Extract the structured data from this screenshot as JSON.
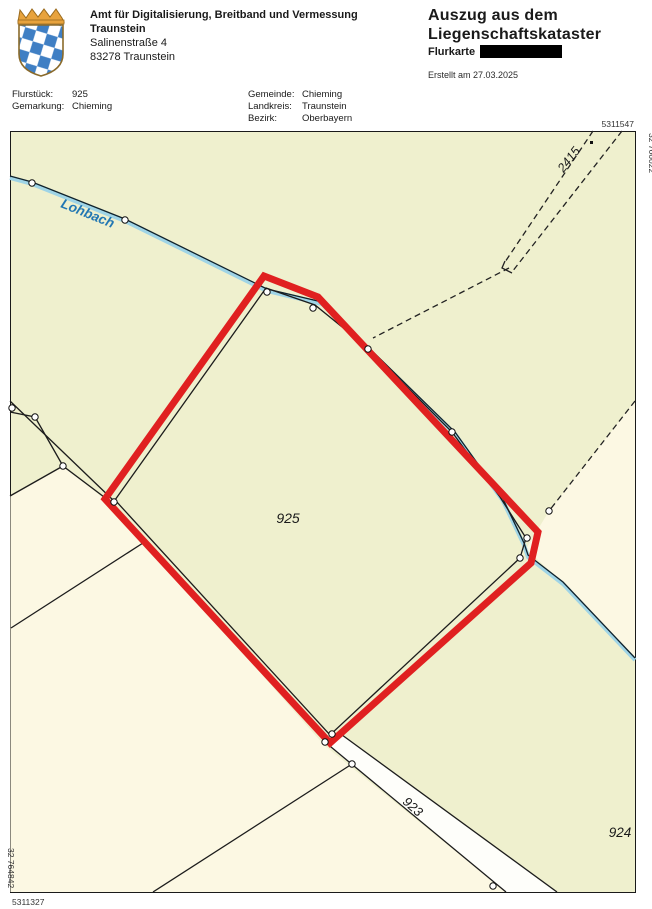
{
  "header": {
    "office_line1": "Amt für Digitalisierung, Breitband und Vermessung",
    "office_line2": "Traunstein",
    "address_street": "Salinenstraße 4",
    "address_city": "83278 Traunstein",
    "title_line1": "Auszug aus dem",
    "title_line2": "Liegenschaftskataster",
    "subtitle_label": "Flurkarte",
    "created_text": "Erstellt am 27.03.2025"
  },
  "info": {
    "left": [
      {
        "label": "Flurstück:",
        "value": "925"
      },
      {
        "label": "Gemarkung:",
        "value": "Chieming"
      }
    ],
    "right": [
      {
        "label": "Gemeinde:",
        "value": "Chieming"
      },
      {
        "label": "Landkreis:",
        "value": "Traunstein"
      },
      {
        "label": "Bezirk:",
        "value": "Oberbayern"
      }
    ]
  },
  "map": {
    "labels": {
      "stream": "Lohbach",
      "parcel_main": "925",
      "parcel_road": "923",
      "parcel_east": "924",
      "parcel_track": "2415"
    },
    "coords": {
      "top_right_northing": "5311547",
      "right_easting": "32 766022",
      "bottom_left_northing": "5311327",
      "left_easting": "32 764842"
    },
    "colors": {
      "highlight_red": "#e02020",
      "parcel_green": "#eff0ce",
      "parcel_cream": "#fcf8e3",
      "road_white": "#fefefa",
      "stream_blue": "#9fd4e6",
      "stream_label_blue": "#2277b3"
    }
  }
}
